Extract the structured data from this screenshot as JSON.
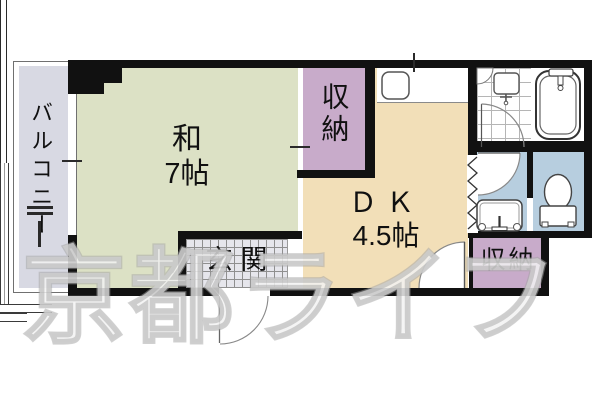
{
  "watermark": {
    "text": "京都ライフ"
  },
  "rooms": {
    "balcony": {
      "label": "バルコニー"
    },
    "japanese_room": {
      "name": "和",
      "area": "7帖"
    },
    "storage_top": {
      "label": "収納"
    },
    "dining_kitchen": {
      "name": "ＤＫ",
      "area": "4.5帖"
    },
    "entrance": {
      "label": "玄関"
    },
    "storage_bottom": {
      "label": "収納"
    }
  },
  "fixtures": {
    "bathtub": "bathtub",
    "bath_wash_basin": "wash-basin",
    "toilet": "toilet",
    "kitchen_sink": "kitchen-sink",
    "laundry_unit": "laundry-pan",
    "folding_door": "folding-door",
    "entrance_door": "entrance-swing-door",
    "bath_door": "bath-swing-door",
    "washroom_door": "washroom-swing-door",
    "dk_storage_door": "dk-swing-door"
  },
  "colors": {
    "wall": "#111111",
    "tatami_room": "#dce1c5",
    "dining_kitchen": "#f2dfb8",
    "storage": "#c8abca",
    "balcony": "#d8d9e3",
    "wet_area": "#b7cedf",
    "entrance_tile": "#e6e6ec",
    "watermark_gray": "#c9c9c9"
  }
}
